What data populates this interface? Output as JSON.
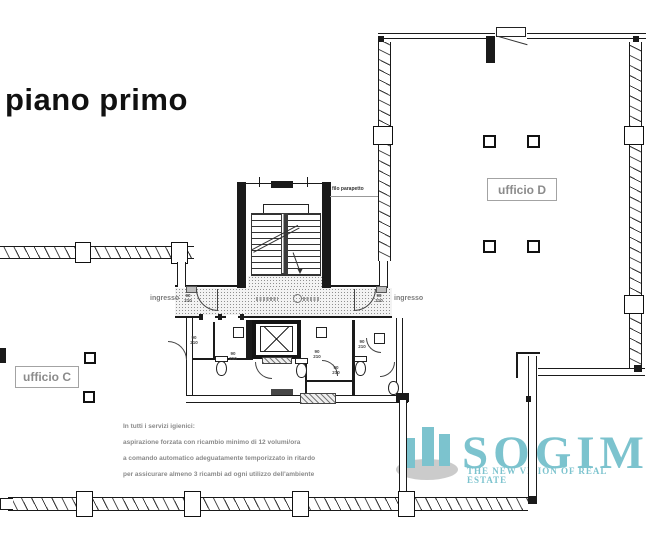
{
  "title": "piano primo",
  "rooms": {
    "office_d": "ufficio D",
    "office_c": "ufficio C"
  },
  "corridor": {
    "entrance_left": "ingresso",
    "entrance_right": "ingresso",
    "parapet_note": "filo parapetto",
    "door_label": {
      "w": "90",
      "h": "210"
    }
  },
  "notes": {
    "line1": "In tutti i servizi igienici:",
    "line2": "aspirazione forzata con ricambio minimo di 12 volumi/ora",
    "line3": "a comando automatico adeguatamente temporizzato in  ritardo",
    "line4": "per assicurare almeno 3 ricambi ad ogni utilizzo dell'ambiente"
  },
  "logo": {
    "name": "SOGIM",
    "tagline": "THE NEW VISION OF REAL ESTATE",
    "accent_color": "#7cc3ce",
    "shadow_color": "#cbcbcb",
    "icon": "bar-chart-building-icon"
  },
  "colors": {
    "wall": "#1a1a1a",
    "label_gray": "#8b8b8b",
    "floor_texture": "#8f8f8f"
  }
}
